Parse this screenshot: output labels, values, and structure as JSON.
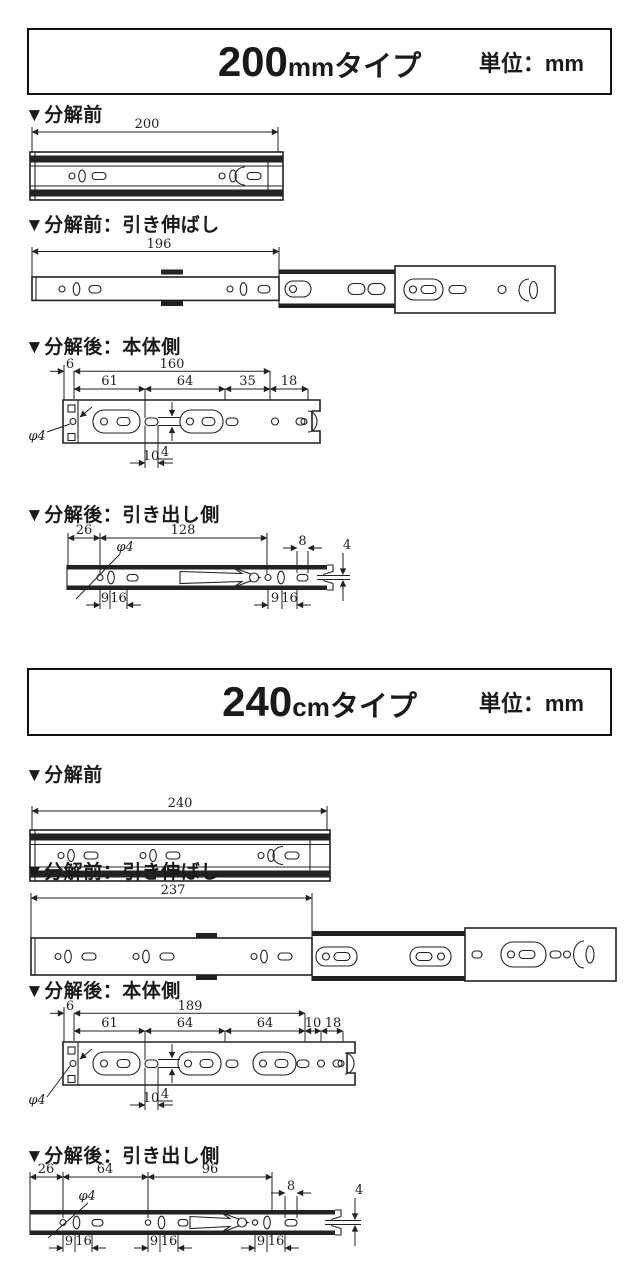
{
  "s200": {
    "header": {
      "num": "200",
      "num_unit": "mm",
      "suffix": "タイプ",
      "unit_label": "単位：mm"
    },
    "labels": {
      "closed": "▼分解前",
      "extended": "▼分解前：引き伸ばし",
      "body": "▼分解後：本体側",
      "drawer": "▼分解後：引き出し側"
    },
    "closed": {
      "total": "200"
    },
    "extended": {
      "total": "196"
    },
    "body": {
      "edge": "6",
      "total": "160",
      "p1": "61",
      "p2": "64",
      "p3": "35",
      "p4": "18",
      "hole_dia": "φ4",
      "slot_w": "10",
      "slot_h": "4"
    },
    "drawer": {
      "lead": "26",
      "span": "128",
      "hole_dia": "φ4",
      "end_slot_w": "8",
      "end_gap": "4",
      "g1_a": "9",
      "g1_b": "16",
      "g2_a": "9",
      "g2_b": "16"
    }
  },
  "s240": {
    "header": {
      "num": "240",
      "num_unit": "cm",
      "suffix": "タイプ",
      "unit_label": "単位：mm"
    },
    "labels": {
      "closed": "▼分解前",
      "extended": "▼分解前：引き伸ばし",
      "body": "▼分解後：本体側",
      "drawer": "▼分解後：引き出し側"
    },
    "closed": {
      "total": "240"
    },
    "extended": {
      "total": "237"
    },
    "body": {
      "edge": "6",
      "total": "189",
      "p1": "61",
      "p2": "64",
      "p3": "64",
      "p4": "10",
      "p5": "18",
      "hole_dia": "φ4",
      "slot_w": "10",
      "slot_h": "4"
    },
    "drawer": {
      "lead": "26",
      "s1": "64",
      "s2": "96",
      "hole_dia": "φ4",
      "end_slot_w": "8",
      "end_gap": "4",
      "g1_a": "9",
      "g1_b": "16",
      "g2_a": "9",
      "g2_b": "16",
      "g3_a": "9",
      "g3_b": "16"
    }
  }
}
